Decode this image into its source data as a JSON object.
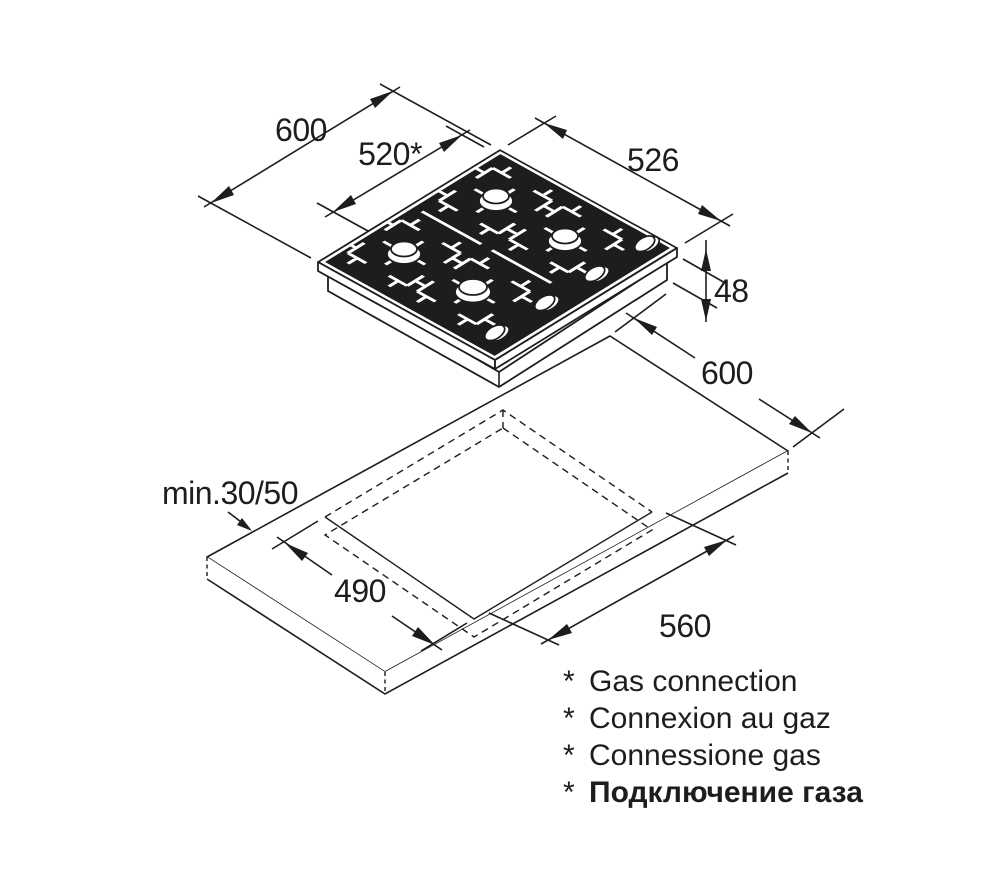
{
  "colors": {
    "ink": "#1d1d1b",
    "background": "#ffffff"
  },
  "hob": {
    "width": "600",
    "gas_connection": "520*",
    "depth": "526",
    "height": "48"
  },
  "worktop": {
    "depth": "600",
    "clearance": "min.30/50",
    "cutout_depth": "490",
    "cutout_width": "560"
  },
  "footnotes": [
    {
      "marker": "*",
      "text": "Gas connection"
    },
    {
      "marker": "*",
      "text": "Connexion au gaz"
    },
    {
      "marker": "*",
      "text": "Connessione gas"
    },
    {
      "marker": "*",
      "text": "Подключение газа"
    }
  ]
}
